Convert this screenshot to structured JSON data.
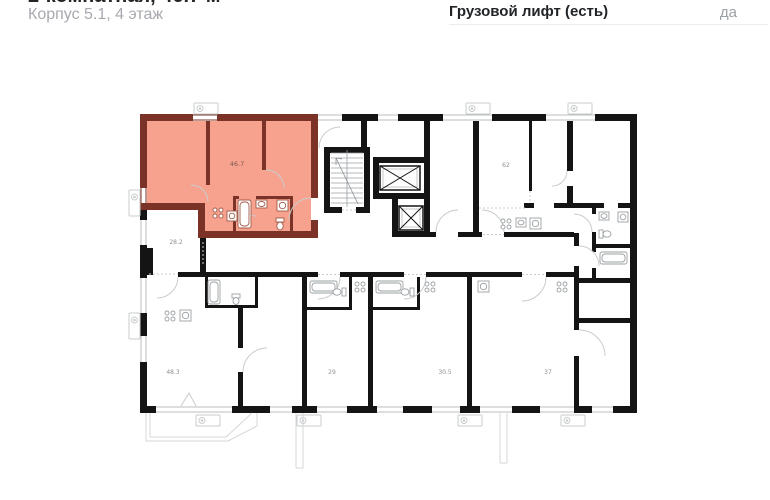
{
  "header": {
    "title": "2-комнатная, 46.7 м²",
    "subtitle": "Корпус 5.1, 4 этаж",
    "spec_label": "Грузовой лифт (есть)",
    "spec_value": "да"
  },
  "plan": {
    "highlight_fill": "#f7a28e",
    "highlight_wall": "#7a3326",
    "wall_color": "#141414",
    "selected_room": {
      "area": "46.7",
      "type": "2-комнатная"
    },
    "rooms": [
      {
        "id": "apt-46-7",
        "area": "46.7"
      },
      {
        "id": "room-28-2",
        "area": "28.2"
      },
      {
        "id": "apt-62",
        "area": "62"
      },
      {
        "id": "apt-48-3",
        "area": "48.3"
      },
      {
        "id": "apt-29",
        "area": "29"
      },
      {
        "id": "apt-30-5",
        "area": "30.5"
      },
      {
        "id": "apt-37",
        "area": "37"
      }
    ]
  }
}
